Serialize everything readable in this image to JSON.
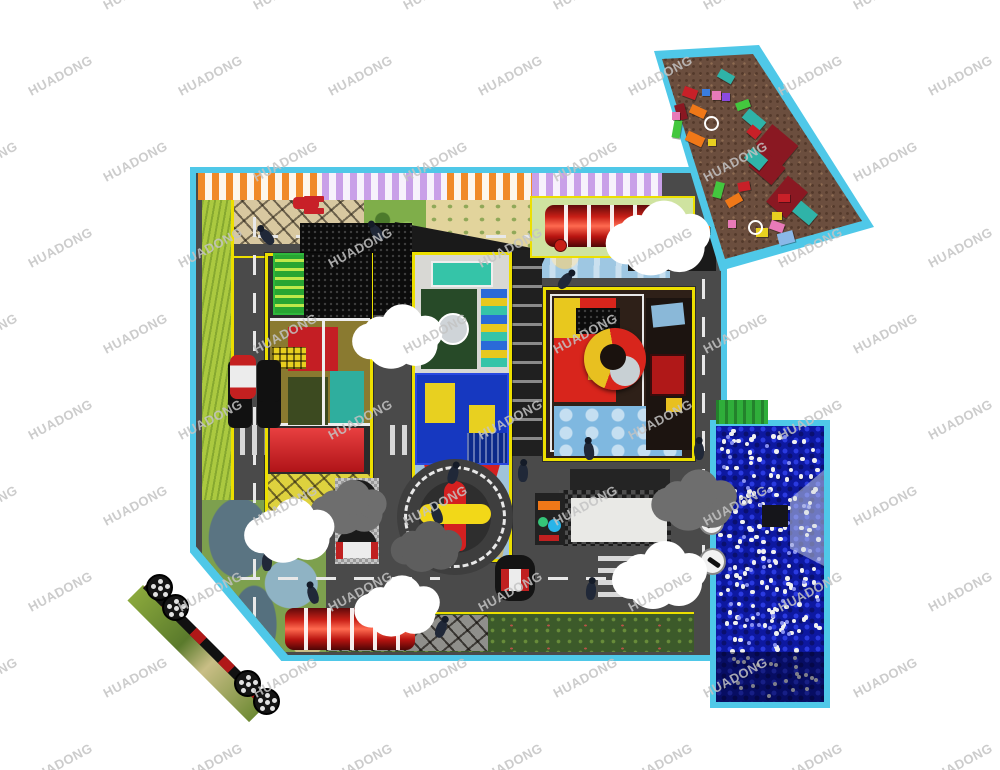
{
  "watermark": {
    "text": "HUADONG"
  },
  "palette": {
    "border_cyan": "#4FC8E8",
    "floor_gray": "#4A4A4A",
    "zone_border_yellow": "#ECDF00",
    "grass_light": "#ABC940",
    "grass_dark": "#3C5A2A",
    "awning_orange": "#F08A28",
    "awning_purple": "#C9A0E8",
    "tunnel_red": "#C81F16",
    "ball_pit_blue": "#0D18A0",
    "ball_white": "#F0F0F0",
    "blocks_ground_brown": "#6B4E3E",
    "slide_red": "#D42020",
    "slide_yellow": "#E8C81E",
    "structure_green": "#2FB83C",
    "structure_teal": "#35C4A8",
    "structure_blue": "#1638C0",
    "cloud_white": "#FFFFFF",
    "cloud_shadow_gray": "#6E6E6E"
  },
  "scene": {
    "regions": {
      "main": {
        "label": "Traffic-town main play floor"
      },
      "ballpit": {
        "label": "Ball pit with white target balls"
      },
      "blocks": {
        "label": "EPP building-blocks zone"
      },
      "zoneA": {
        "label": "Left toddler play structure"
      },
      "zoneB": {
        "label": "Center play structure with red slide"
      },
      "zoneC": {
        "label": "Right play structure with spiral tube slide"
      },
      "roundabout": {
        "label": "Road roundabout with rocket carousel"
      },
      "tunnelTop": {
        "label": "Red crawl tunnel (top)"
      },
      "tunnelBottom": {
        "label": "Red crawl tunnel (bottom)"
      },
      "booths": {
        "label": "Seating booths"
      },
      "table": {
        "label": "Party table"
      },
      "track": {
        "label": "Wheel track at corner"
      }
    }
  }
}
